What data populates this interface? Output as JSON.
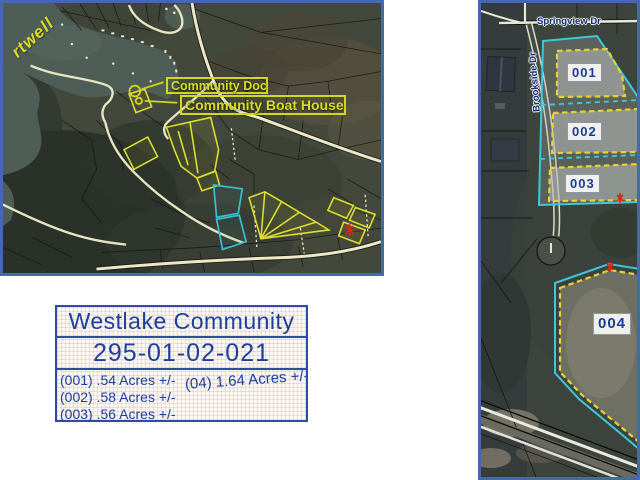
{
  "colors": {
    "map_border_blue": "#4568b0",
    "info_border_blue": "#2d4ea0",
    "info_text_navy": "#1d3f9e",
    "annotation_yellow": "#d8dd1e",
    "parcel_outline_cyan": "#3cc8dc",
    "parcel_dash_yellow": "#e8d232",
    "street_label_navy": "#16307e",
    "marker_red": "#e02513",
    "water_teal": "#4e5e57",
    "road_cream": "#ece8c8"
  },
  "left_map": {
    "water_label": "rtwell",
    "annotations": [
      {
        "label": "Community Doc"
      },
      {
        "label": "Community Boat House"
      }
    ]
  },
  "info_box": {
    "title": "Westlake Community",
    "parcel_id": "295-01-02-021",
    "acre_lines": [
      "(001) .54 Acres +/-",
      "(002) .58 Acres +/-",
      "(003) .56 Acres +/-"
    ],
    "acre_line_right": "(04) 1.64 Acres +/-"
  },
  "right_map": {
    "streets": [
      {
        "name": "Springview Dr"
      },
      {
        "name": "Brookside Dr"
      }
    ],
    "parcels": [
      {
        "id": "001"
      },
      {
        "id": "002"
      },
      {
        "id": "003"
      },
      {
        "id": "004"
      }
    ]
  }
}
